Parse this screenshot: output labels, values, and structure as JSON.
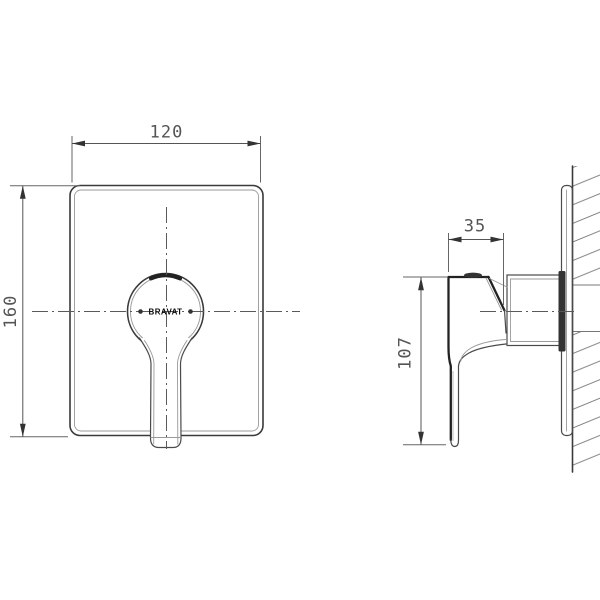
{
  "brand": {
    "logo_text": "BRAVAT"
  },
  "dimensions": {
    "front_width": {
      "value": "120"
    },
    "front_height": {
      "value": "160"
    },
    "side_handle_depth": {
      "value": "35"
    },
    "side_handle_height": {
      "value": "107"
    }
  },
  "colors": {
    "line": "#3a3a3a",
    "dimension": "#555555",
    "hatch": "#777777",
    "background": "#ffffff"
  }
}
